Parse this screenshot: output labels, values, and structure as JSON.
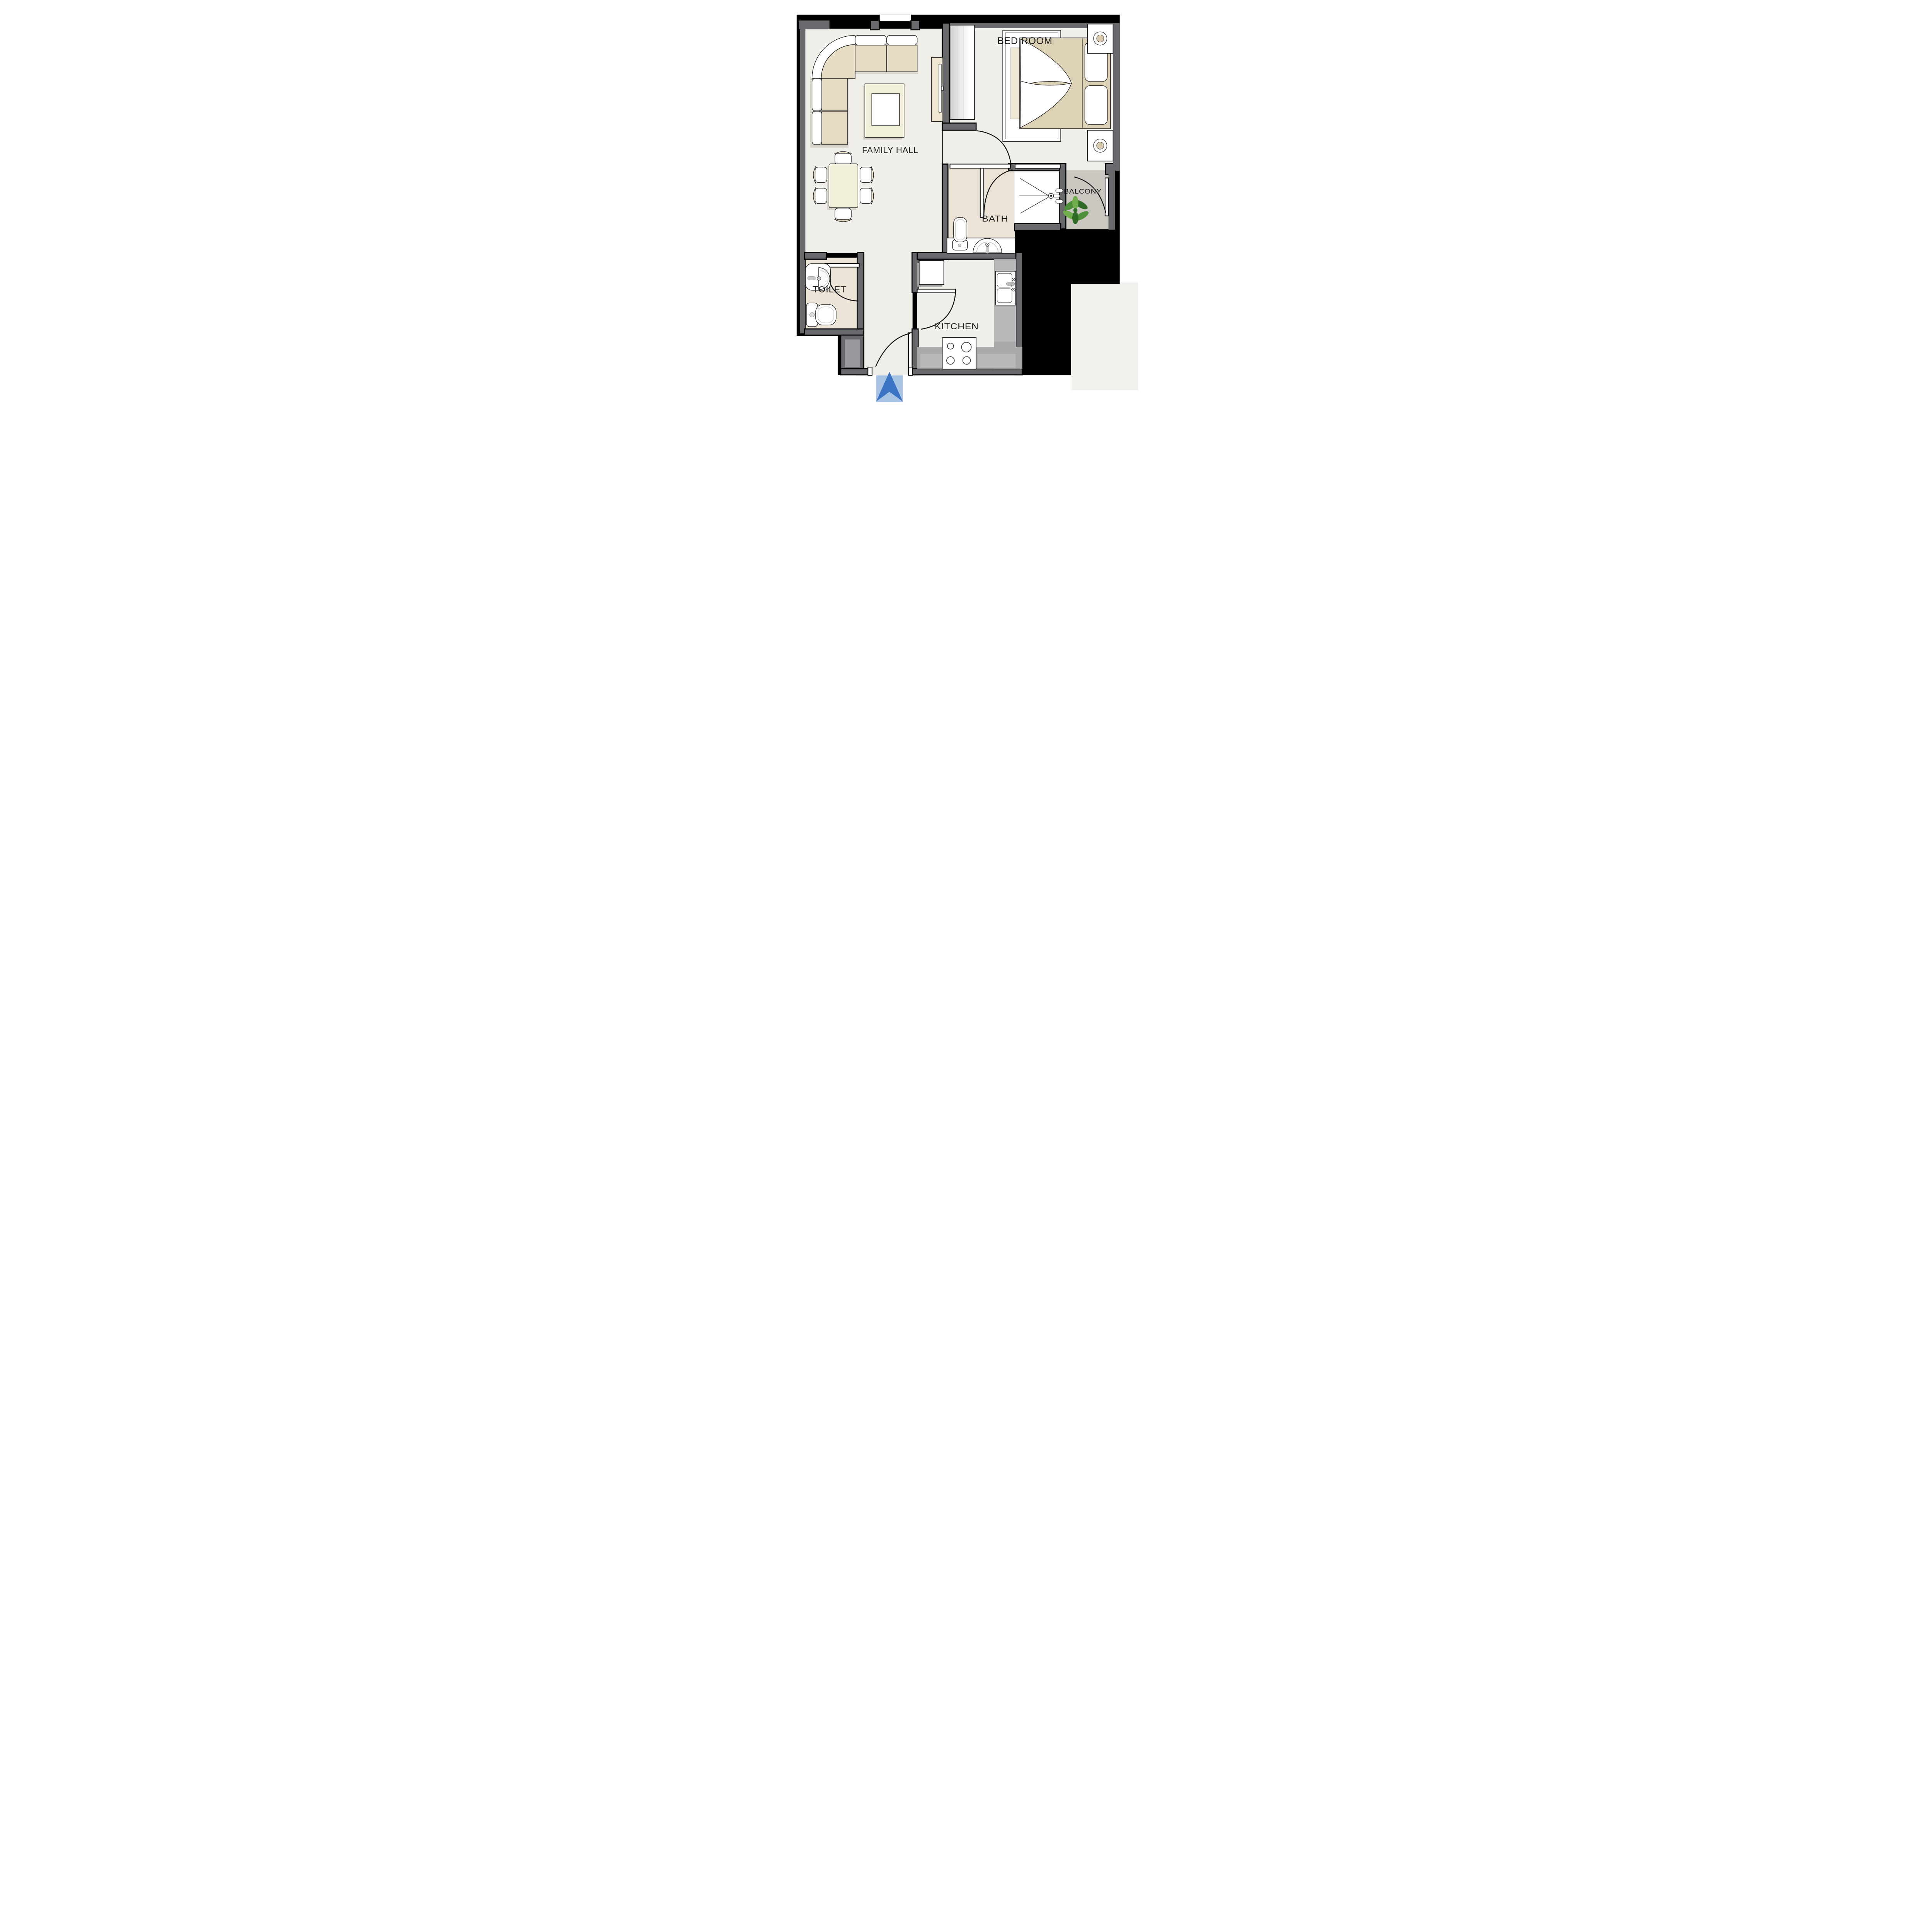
{
  "plan": {
    "type": "apartment-floor-plan",
    "rooms": [
      {
        "id": "family-hall",
        "label": "FAMILY HALL"
      },
      {
        "id": "bed-room",
        "label": "BED ROOM"
      },
      {
        "id": "bath",
        "label": "BATH"
      },
      {
        "id": "balcony",
        "label": "BALCONY"
      },
      {
        "id": "toilet",
        "label": "TOILET"
      },
      {
        "id": "kitchen",
        "label": "KITCHEN"
      }
    ],
    "fixtures": {
      "family_hall": [
        "corner-sofa",
        "coffee-table",
        "dining-table",
        "dining-chairs-x6",
        "tv-unit"
      ],
      "bed_room": [
        "double-bed",
        "pillows-x2",
        "nightstands-x2",
        "table-lamps-x2",
        "rug",
        "wardrobe"
      ],
      "bath": [
        "wc",
        "washbasin",
        "vanity-counter",
        "shower-enclosure",
        "shower-mixer"
      ],
      "balcony": [
        "potted-plant",
        "swing-door",
        "sliding-panel"
      ],
      "toilet": [
        "wc",
        "wall-washbasin"
      ],
      "kitchen": [
        "fridge",
        "double-bowl-sink",
        "hob-4-burner",
        "counters"
      ]
    },
    "doors": [
      "entry-door",
      "bedroom-door",
      "bath-door",
      "toilet-door",
      "kitchen-door",
      "balcony-door"
    ],
    "entry_marker": {
      "icon": "entrance-arrow",
      "direction": "up"
    }
  },
  "colors": {
    "wall": "#67696d",
    "wall_light": "#97999c",
    "outside": "#f1f0ec",
    "floor": "#f0efe9",
    "floor_warm": "#ebe3d5",
    "floor_toilet": "#ece5d8",
    "floor_balcony": "#c9c7c0",
    "counter": "#a9a9a9",
    "counter_light": "#b9b9b9",
    "sofa_tan": "#e5dcc3",
    "bed_tan": "#ddd2b6",
    "table_cream": "#f1eeda",
    "rug_runner": "#efe8d4",
    "tv_beige": "#efe7d2",
    "lamp_tan": "#d7cbac",
    "shadow": "#d8d5cc",
    "arrow_blue": "#3a74c2",
    "arrow_band": "#a9c3e4",
    "plant_green": "#4e8f3a",
    "plant_green_dark": "#2f6b27",
    "plant_green_light": "#6fae4a"
  }
}
